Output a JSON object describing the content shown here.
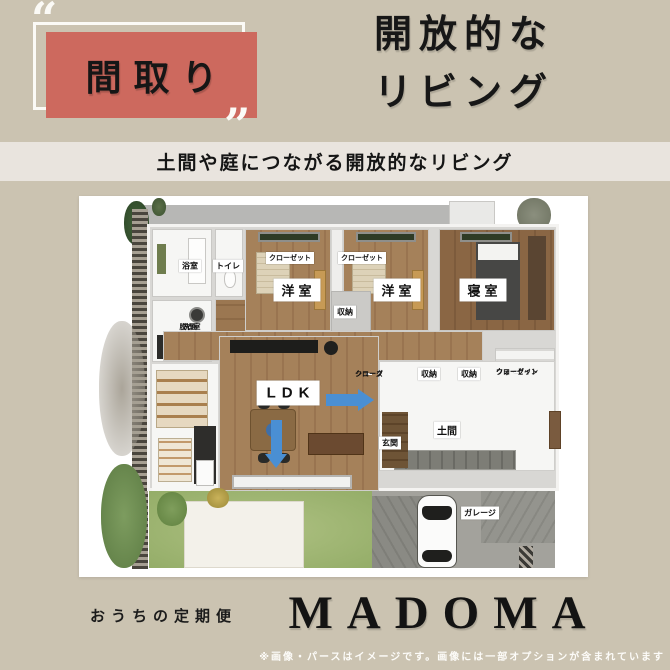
{
  "header": {
    "quote_open": "“",
    "quote_close": "”",
    "badge_label": "間取り",
    "title_line1": "開放的な",
    "title_line2": "リビング",
    "banner": "土間や庭につながる開放的なリビング"
  },
  "floorplan": {
    "bath": "浴室",
    "toilet": "トイレ",
    "washroom_line1": "洗面",
    "washroom_line2": "脱衣室",
    "closet_left": "クローゼット",
    "closet_right": "クローゼット",
    "western_room_left": "洋室",
    "western_room_right": "洋室",
    "bedroom": "寝室",
    "storage_center": "収納",
    "shoes_closet_line1": "シューズ",
    "shoes_closet_line2": "クローク",
    "storage_1": "収納",
    "storage_2": "収納",
    "walkin_line1": "ウォークイン",
    "walkin_line2": "クローゼット",
    "ldk": "LDK",
    "entrance": "玄関",
    "doma": "土間",
    "garage": "ガレージ"
  },
  "footer": {
    "tagline": "おうちの定期便",
    "brand": "MADOMA",
    "disclaimer": "※画像・パースはイメージです。画像には一部オプションが含まれています"
  },
  "colors": {
    "background": "#cbc3b1",
    "accent_red": "#cd695e",
    "banner_bg": "#e9e4de",
    "arrow_blue": "#4a8fd3"
  }
}
